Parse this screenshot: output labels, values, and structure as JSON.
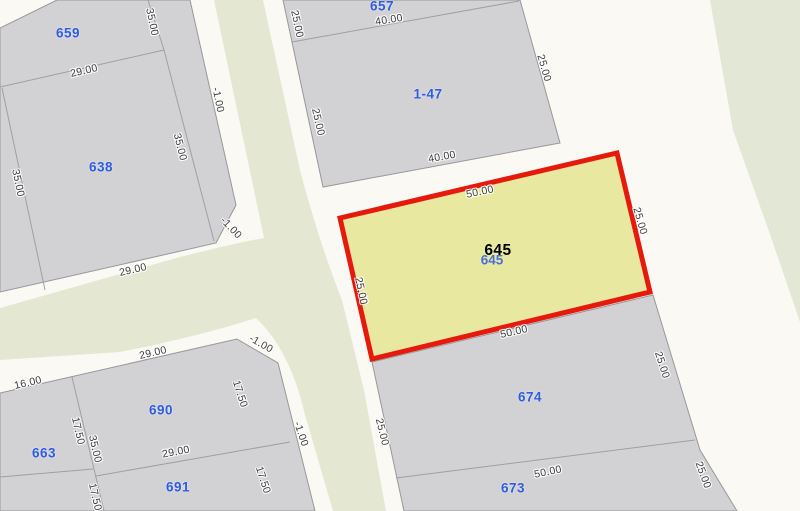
{
  "map": {
    "type": "cadastral-parcel-map",
    "selected_parcel": {
      "number": "645",
      "shadow_number": "645",
      "frontage_top": "50.00",
      "frontage_bottom": "50.00",
      "side_left": "25.00",
      "side_right": "25.00"
    },
    "colors": {
      "road_background": "#FAF9F4",
      "parcel_fill": "#D2D2D4",
      "parcel_stroke": "#97989B",
      "road_median": "#E4E8D3",
      "greenspace": "#E3E7D5",
      "selected_fill": "#E8E8A0",
      "selected_stroke": "#E6190D",
      "parcel_number_text": "#2E5CE2",
      "dimension_text": "#3E3E3E",
      "selected_number_text": "#000000"
    }
  },
  "parcel_numbers": [
    {
      "text": "659"
    },
    {
      "text": "638"
    },
    {
      "text": "657"
    },
    {
      "text": "1-47"
    },
    {
      "text": "674"
    },
    {
      "text": "673"
    },
    {
      "text": "690"
    },
    {
      "text": "691"
    },
    {
      "text": "663"
    }
  ],
  "dimension_labels": [
    {
      "text": "35.00"
    },
    {
      "text": "29.00"
    },
    {
      "text": "-1.00"
    },
    {
      "text": "35.00"
    },
    {
      "text": "35.00"
    },
    {
      "text": "29.00"
    },
    {
      "text": "-1.00"
    },
    {
      "text": "40.00"
    },
    {
      "text": "25.00"
    },
    {
      "text": "25.00"
    },
    {
      "text": "25.00"
    },
    {
      "text": "40.00"
    },
    {
      "text": "50.00"
    },
    {
      "text": "25.00"
    },
    {
      "text": "25.00"
    },
    {
      "text": "50.00"
    },
    {
      "text": "25.00"
    },
    {
      "text": "25.00"
    },
    {
      "text": "50.00"
    },
    {
      "text": "25.00"
    },
    {
      "text": "16.00"
    },
    {
      "text": "29.00"
    },
    {
      "text": "-1.00"
    },
    {
      "text": "17.50"
    },
    {
      "text": "17.50"
    },
    {
      "text": "35.00"
    },
    {
      "text": "29.00"
    },
    {
      "text": "17.50"
    },
    {
      "text": "17.50"
    },
    {
      "text": "-1.00"
    }
  ]
}
